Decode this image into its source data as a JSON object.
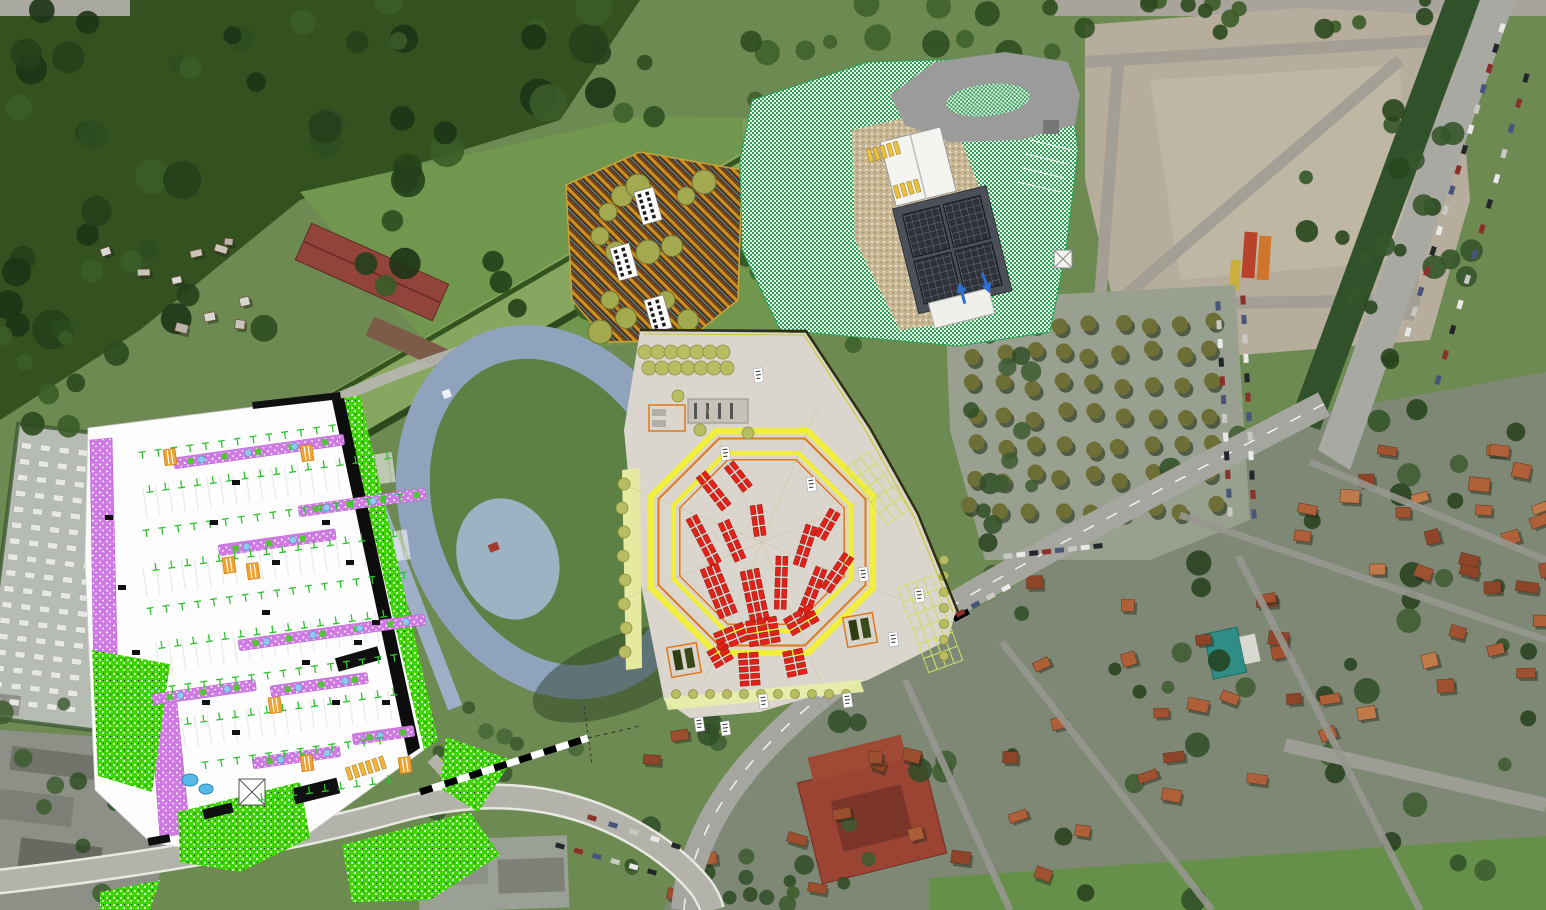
{
  "palette": {
    "photo_green": "#6d8a52",
    "forest": "#2d4d20",
    "field": "#71974e",
    "canal_grass": "#87a65f",
    "dirt_lot": "#b6ad9c",
    "asphalt": "#a6a6a0",
    "roof_red": "#a0512f",
    "plan_white": "#fdfdfd",
    "plan_purple": "#cf7ae3",
    "plan_green_stipple": "#3ed400",
    "plan_tree_tick": "#2fc22f",
    "plan_orange_box": "#f0a030",
    "market_beige": "#dad6cd",
    "stall_red": "#e32119",
    "octagon_yellow": "#f2ee3e",
    "octagon_orange": "#e0781c",
    "olive_tree": "#b9bd62",
    "hatch_brown": "#5a2a1c",
    "hatch_gold": "#c8921e",
    "hatch_teal": "#3f9d9d",
    "checker_green": "#2f9e57",
    "solar_roof": "#2d323a",
    "track_ring": "#8fa3bd",
    "track_infield": "#5d8145",
    "boundary_dark": "#2f2f10",
    "boundary_yellow": "#c9c92e",
    "arrow_blue": "#2f6fd0",
    "pond_blue": "#56b9e8"
  },
  "gen": {
    "treeRegions": [
      {
        "seed": 1,
        "n": 60,
        "x": 0,
        "y": 0,
        "w": 620,
        "h": 330,
        "rmin": 8,
        "rmax": 20,
        "colors": [
          "#23401b",
          "#2d4d20",
          "#1c3416",
          "#3a5c28"
        ],
        "op": 0.9
      },
      {
        "seed": 2,
        "n": 24,
        "x": 620,
        "y": 0,
        "w": 470,
        "h": 120,
        "rmin": 7,
        "rmax": 14,
        "colors": [
          "#2b4a1e",
          "#3c5e2a"
        ],
        "op": 0.85
      },
      {
        "seed": 3,
        "n": 26,
        "x": 1295,
        "y": 0,
        "w": 180,
        "h": 430,
        "rmin": 6,
        "rmax": 12,
        "colors": [
          "#28461e",
          "#35552a"
        ],
        "op": 0.9
      },
      {
        "seed": 4,
        "n": 42,
        "x": 985,
        "y": 430,
        "w": 555,
        "h": 470,
        "rmin": 6,
        "rmax": 13,
        "colors": [
          "#2f4d28",
          "#3d5c31",
          "#24401d"
        ],
        "op": 0.85
      },
      {
        "seed": 5,
        "n": 16,
        "x": 620,
        "y": 720,
        "w": 360,
        "h": 180,
        "rmin": 6,
        "rmax": 12,
        "colors": [
          "#2f4d28",
          "#3d5c31"
        ],
        "op": 0.85
      },
      {
        "seed": 6,
        "n": 12,
        "x": 0,
        "y": 330,
        "w": 120,
        "h": 110,
        "rmin": 7,
        "rmax": 13,
        "colors": [
          "#2b4a1e",
          "#3a5c28"
        ],
        "op": 0.9
      },
      {
        "seed": 7,
        "n": 12,
        "x": 0,
        "y": 700,
        "w": 150,
        "h": 200,
        "rmin": 6,
        "rmax": 12,
        "colors": [
          "#2c4a22",
          "#3a5a2c"
        ],
        "op": 0.8
      },
      {
        "seed": 8,
        "n": 14,
        "x": 735,
        "y": 150,
        "w": 150,
        "h": 195,
        "rmin": 7,
        "rmax": 13,
        "colors": [
          "#2d4d22",
          "#3c5e2a"
        ],
        "op": 0.85
      },
      {
        "seed": 10,
        "n": 10,
        "x": 430,
        "y": 690,
        "w": 190,
        "h": 120,
        "rmin": 6,
        "rmax": 11,
        "colors": [
          "#33522a",
          "#426335"
        ],
        "op": 0.8
      },
      {
        "seed": 11,
        "n": 14,
        "x": 955,
        "y": 330,
        "w": 90,
        "h": 290,
        "rmin": 6,
        "rmax": 11,
        "colors": [
          "#2f4d26",
          "#3d5c31"
        ],
        "op": 0.85
      },
      {
        "seed": 12,
        "n": 12,
        "x": 1080,
        "y": 0,
        "w": 460,
        "h": 36,
        "rmin": 6,
        "rmax": 10,
        "colors": [
          "#2b4a1e",
          "#3a5c28"
        ],
        "op": 0.9
      },
      {
        "seed": 13,
        "n": 10,
        "x": 620,
        "y": 865,
        "w": 300,
        "h": 45,
        "rmin": 6,
        "rmax": 10,
        "colors": [
          "#2c4a22",
          "#3a5a2c"
        ],
        "op": 0.85
      }
    ],
    "houseRegions": [
      {
        "seed": 21,
        "n": 26,
        "x": 1240,
        "y": 430,
        "w": 300,
        "h": 300,
        "wmin": 13,
        "wmax": 22,
        "hmin": 9,
        "hmax": 14,
        "colors": [
          "#a0512f",
          "#b06038",
          "#8d4428",
          "#c07a4a"
        ]
      },
      {
        "seed": 22,
        "n": 22,
        "x": 990,
        "y": 560,
        "w": 330,
        "h": 320,
        "wmin": 13,
        "wmax": 22,
        "hmin": 9,
        "hmax": 14,
        "colors": [
          "#a0512f",
          "#b06038",
          "#8d4428"
        ]
      },
      {
        "seed": 23,
        "n": 12,
        "x": 640,
        "y": 720,
        "w": 330,
        "h": 170,
        "wmin": 12,
        "wmax": 20,
        "hmin": 9,
        "hmax": 13,
        "colors": [
          "#9c4f2e",
          "#ad5d36",
          "#8d4428"
        ]
      },
      {
        "seed": 24,
        "n": 6,
        "x": 745,
        "y": 165,
        "w": 130,
        "h": 165,
        "wmin": 11,
        "wmax": 16,
        "hmin": 8,
        "hmax": 11,
        "colors": [
          "#9c4f2e",
          "#b06038"
        ]
      },
      {
        "seed": 25,
        "n": 10,
        "x": 90,
        "y": 235,
        "w": 190,
        "h": 95,
        "wmin": 8,
        "wmax": 13,
        "hmin": 6,
        "hmax": 9,
        "colors": [
          "#d8d8d2",
          "#c9c5ba",
          "#b8b4a8"
        ]
      },
      {
        "seed": 26,
        "n": 8,
        "x": 1380,
        "y": 430,
        "w": 160,
        "h": 180,
        "wmin": 14,
        "wmax": 24,
        "hmin": 10,
        "hmax": 15,
        "colors": [
          "#a0512f",
          "#8d4428",
          "#b06038"
        ]
      }
    ],
    "carRows": [
      [
        1502,
        28,
        1408,
        332,
        16
      ],
      [
        1526,
        78,
        1438,
        380,
        13
      ],
      [
        1243,
        300,
        1254,
        514,
        12
      ],
      [
        1218,
        306,
        1230,
        512,
        12
      ],
      [
        1008,
        556,
        1098,
        546,
        8
      ],
      [
        930,
        630,
        1006,
        588,
        6
      ],
      [
        560,
        846,
        652,
        872,
        6
      ],
      [
        592,
        818,
        676,
        846,
        5
      ]
    ],
    "carColors": [
      "#e9e9e9",
      "#23262b",
      "#8a2f2a",
      "#46557a",
      "#c9c9c4"
    ],
    "treeGrid": {
      "x": 972,
      "y": 322,
      "cols": 9,
      "rows": 7,
      "dx": 30,
      "dy": 31,
      "r": 8,
      "jit": 5,
      "seed": 9
    },
    "graves": {
      "x": 6,
      "y": 448,
      "cols": 5,
      "rows": 17,
      "dx": 19,
      "dy": 16,
      "w": 10,
      "h": 6
    },
    "tRows": [
      [
        142,
        452,
        13,
        0
      ],
      [
        150,
        492,
        16,
        1
      ],
      [
        146,
        530,
        17,
        0
      ],
      [
        156,
        570,
        16,
        1
      ],
      [
        150,
        608,
        17,
        0
      ],
      [
        162,
        648,
        16,
        1
      ],
      [
        172,
        686,
        15,
        0
      ],
      [
        188,
        724,
        14,
        1
      ],
      [
        205,
        762,
        12,
        0
      ],
      [
        262,
        800,
        9,
        1
      ]
    ],
    "purpleRows": [
      [
        173,
        458,
        172
      ],
      [
        298,
        506,
        128
      ],
      [
        218,
        545,
        118
      ],
      [
        238,
        640,
        188
      ],
      [
        152,
        694,
        104
      ],
      [
        270,
        686,
        98
      ],
      [
        252,
        758,
        88
      ],
      [
        352,
        734,
        62
      ]
    ],
    "orangeBoxes": [
      [
        222,
        558
      ],
      [
        246,
        564
      ],
      [
        268,
        698
      ],
      [
        300,
        756
      ],
      [
        398,
        758
      ],
      [
        300,
        446
      ],
      [
        163,
        450
      ]
    ],
    "blackTags": [
      [
        105,
        515
      ],
      [
        118,
        585
      ],
      [
        132,
        650
      ],
      [
        210,
        520
      ],
      [
        232,
        480
      ],
      [
        322,
        520
      ],
      [
        346,
        560
      ],
      [
        372,
        620
      ],
      [
        262,
        610
      ],
      [
        302,
        660
      ],
      [
        202,
        700
      ],
      [
        232,
        730
      ],
      [
        332,
        700
      ],
      [
        382,
        700
      ],
      [
        272,
        560
      ],
      [
        354,
        640
      ]
    ],
    "stallGroups": [
      [
        696,
        478,
        -38,
        4,
        2
      ],
      [
        724,
        468,
        -38,
        3,
        2
      ],
      [
        686,
        520,
        -28,
        5,
        2
      ],
      [
        718,
        524,
        -24,
        4,
        2
      ],
      [
        750,
        506,
        -8,
        3,
        2
      ],
      [
        700,
        570,
        -22,
        5,
        3
      ],
      [
        740,
        572,
        -12,
        5,
        3
      ],
      [
        776,
        556,
        2,
        5,
        2
      ],
      [
        806,
        524,
        18,
        4,
        2
      ],
      [
        830,
        508,
        30,
        3,
        2
      ],
      [
        816,
        566,
        22,
        5,
        2
      ],
      [
        844,
        552,
        34,
        4,
        2
      ],
      [
        742,
        622,
        68,
        3,
        3
      ],
      [
        776,
        616,
        80,
        3,
        4
      ],
      [
        810,
        604,
        60,
        3,
        3
      ],
      [
        758,
        652,
        86,
        2,
        5
      ],
      [
        802,
        648,
        78,
        2,
        4
      ],
      [
        724,
        642,
        60,
        2,
        3
      ]
    ],
    "octagon": {
      "cx": 762,
      "cy": 542,
      "rings": [
        [
          120,
          "#f2ee3e",
          6.5
        ],
        [
          112,
          "#e0781c",
          2
        ],
        [
          96,
          "#f2ee3e",
          4.5
        ],
        [
          89,
          "#e0781c",
          1.5
        ]
      ],
      "fanLen": 150
    },
    "bays": [
      {
        "x": 898,
        "y": 588,
        "rot": -20,
        "cols": 4,
        "rows": 6,
        "cw": 9,
        "ch": 15
      },
      {
        "x": 846,
        "y": 468,
        "rot": -36,
        "cols": 3,
        "rows": 5,
        "cw": 9,
        "ch": 14
      }
    ],
    "whiteLabels": [
      [
        753,
        369
      ],
      [
        720,
        447
      ],
      [
        694,
        718
      ],
      [
        720,
        722
      ],
      [
        758,
        695
      ],
      [
        842,
        694
      ],
      [
        888,
        633
      ],
      [
        914,
        589
      ],
      [
        858,
        568
      ],
      [
        806,
        478
      ]
    ],
    "mktTreeRows": [
      {
        "x0": 645,
        "y": 352,
        "dx": 13,
        "dy": 0,
        "n": 7,
        "r": 7
      },
      {
        "x0": 649,
        "y": 368,
        "dx": 13,
        "dy": 0,
        "n": 7,
        "r": 7
      },
      {
        "x0": 676,
        "y": 694,
        "dx": 17,
        "dy": 0,
        "n": 11,
        "r": 4.5
      },
      {
        "x0": 944,
        "y": 560,
        "dx": 0,
        "dy": 16,
        "n": 7,
        "r": 4.5
      }
    ],
    "mktTreeSingles": [
      [
        700,
        430
      ],
      [
        748,
        433
      ],
      [
        678,
        396
      ],
      [
        624,
        484
      ],
      [
        622,
        508
      ],
      [
        624,
        532
      ],
      [
        623,
        556
      ],
      [
        625,
        580
      ],
      [
        624,
        604
      ],
      [
        626,
        628
      ],
      [
        625,
        652
      ]
    ],
    "trucks": [
      [
        684,
        660
      ],
      [
        860,
        630
      ]
    ],
    "housingBuildings": [
      [
        648,
        206
      ],
      [
        624,
        262
      ],
      [
        658,
        314
      ]
    ],
    "housingTrees": [
      [
        608,
        212
      ],
      [
        622,
        196
      ],
      [
        638,
        186
      ],
      [
        600,
        236
      ],
      [
        616,
        252
      ],
      [
        648,
        252
      ],
      [
        610,
        300
      ],
      [
        626,
        318
      ],
      [
        600,
        332
      ],
      [
        666,
        300
      ],
      [
        688,
        320
      ],
      [
        704,
        182
      ],
      [
        686,
        196
      ],
      [
        672,
        246
      ]
    ],
    "crossings": [
      {
        "x": 345,
        "y": 768,
        "rot": -18,
        "n": 6,
        "color": "#f0b43c"
      },
      {
        "x": 866,
        "y": 150,
        "rot": -16,
        "n": 5,
        "color": "#e8c23f"
      },
      {
        "x": 893,
        "y": 186,
        "rot": -16,
        "n": 4,
        "color": "#e8c23f"
      }
    ],
    "arrows": [
      [
        962,
        293,
        -15
      ],
      [
        986,
        283,
        160
      ]
    ]
  }
}
